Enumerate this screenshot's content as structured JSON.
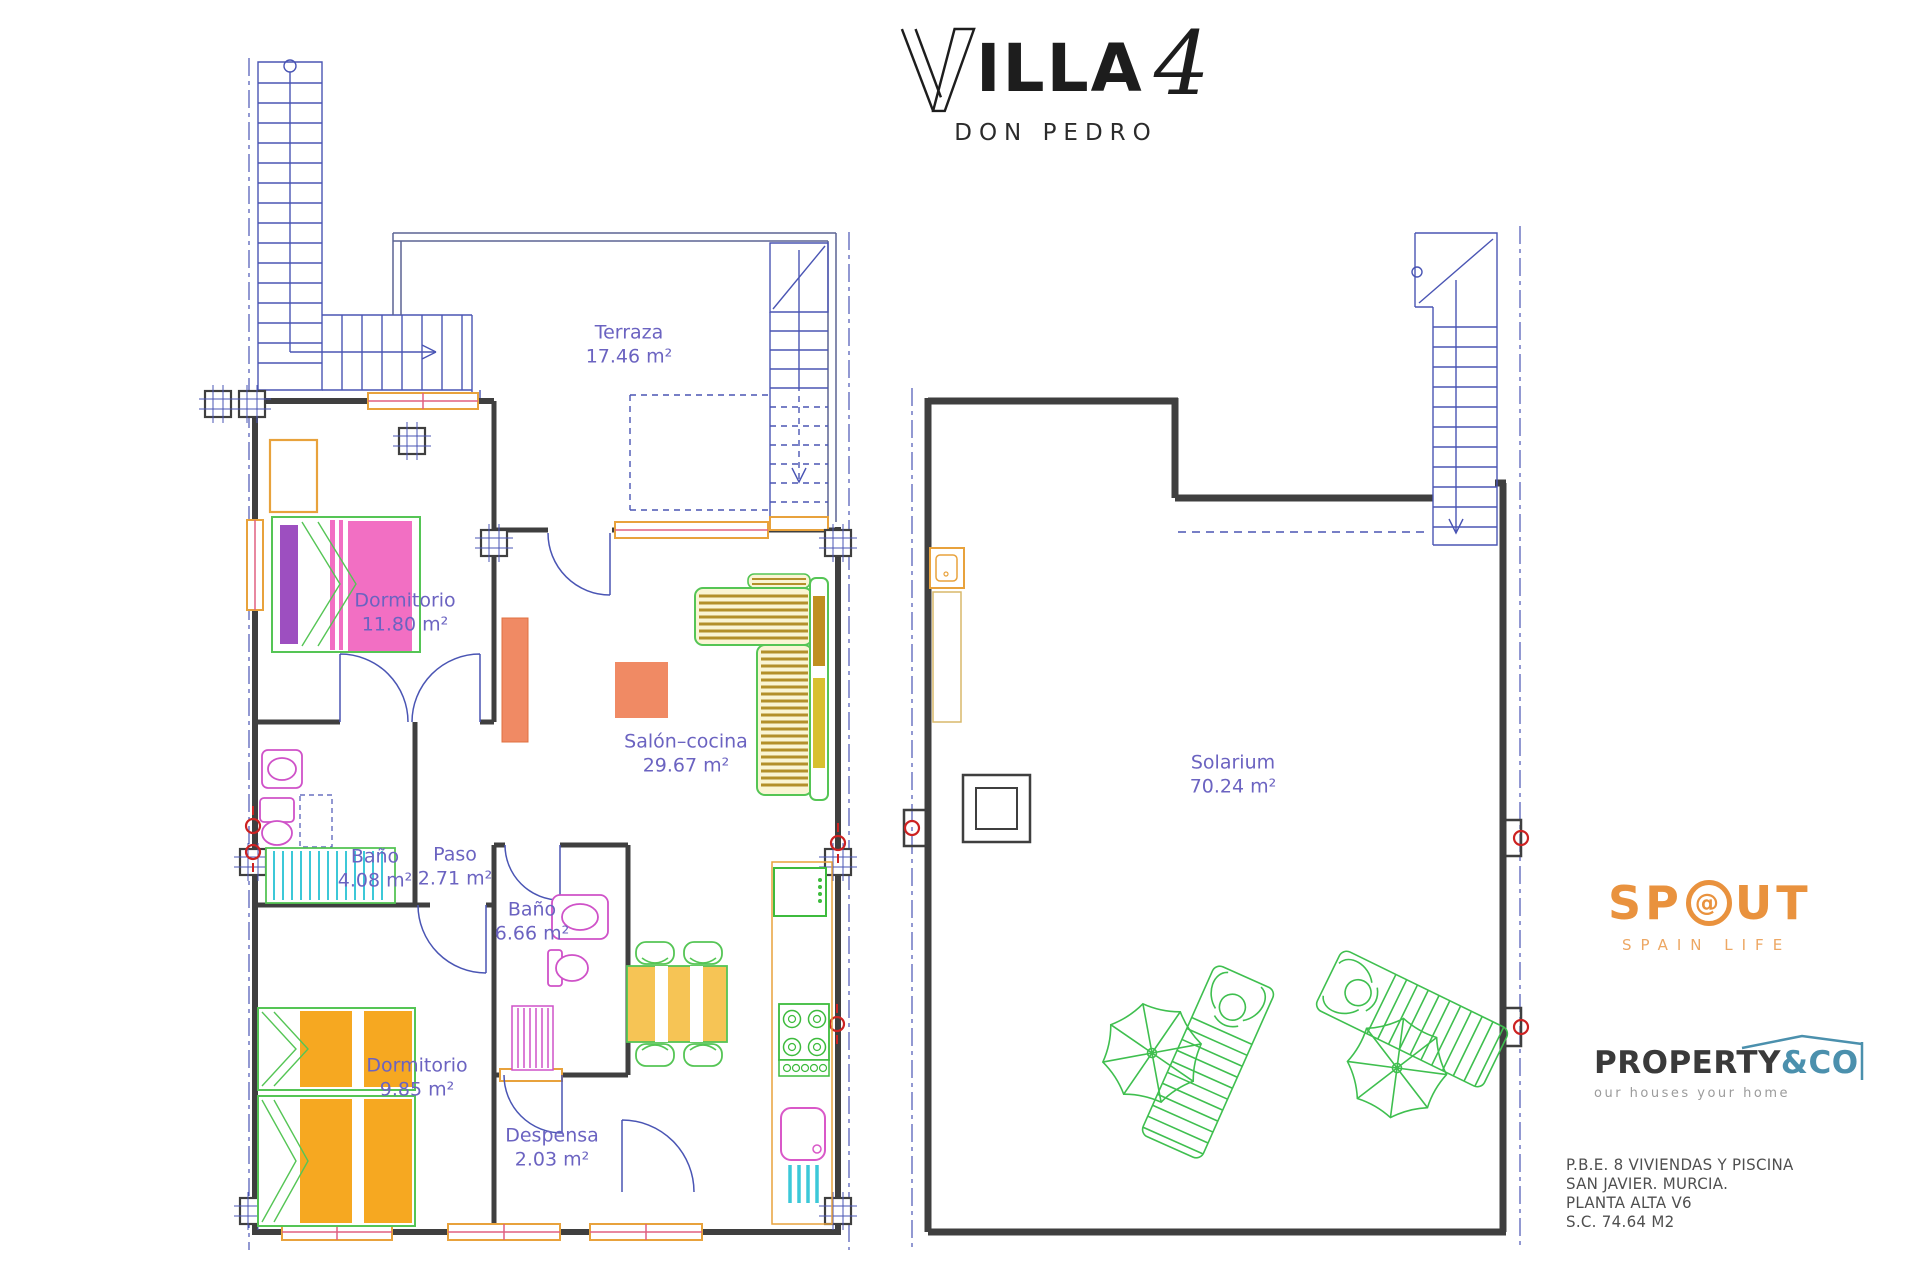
{
  "title": {
    "wordmark": "VILLA",
    "brand_rest": "ILLA",
    "number": "4",
    "subtitle": "DON PEDRO"
  },
  "floorplans": {
    "left": {
      "rooms": [
        {
          "name": "Terraza",
          "area": "17.46 m²"
        },
        {
          "name": "Dormitorio",
          "area": "11.80 m²"
        },
        {
          "name": "Baño",
          "area": "4.08 m²"
        },
        {
          "name": "Paso",
          "area": "2.71 m²"
        },
        {
          "name": "Salón–cocina",
          "area": "29.67 m²"
        },
        {
          "name": "Baño",
          "area": "6.66 m²"
        },
        {
          "name": "Dormitorio",
          "area": "9.85 m²"
        },
        {
          "name": "Despensa",
          "area": "2.03 m²"
        }
      ]
    },
    "right": {
      "rooms": [
        {
          "name": "Solarium",
          "area": "70.24 m²"
        }
      ]
    }
  },
  "branding": {
    "spout": {
      "part1": "SP",
      "o_glyph": "@",
      "part2": "UT",
      "subtitle": "SPAIN LIFE",
      "color": "#e9923e"
    },
    "property_co": {
      "part1": "PROPERTY",
      "part2": "&CO",
      "tagline": "our houses your home",
      "accent": "#4b90ad"
    }
  },
  "project_info": {
    "lines": [
      "P.B.E. 8 VIVIENDAS Y PISCINA",
      "SAN JAVIER. MURCIA.",
      "PLANTA ALTA V6",
      "S.C. 74.64 M2"
    ]
  },
  "colors": {
    "label_text": "#6b63c1",
    "walls": "#3f3f3f",
    "cad_blue": "#4a55b4",
    "window_orange": "#e8a23c",
    "furniture_green": "#55c555",
    "bed_pink": "#f26fc3",
    "pillow_purple": "#9d4fc0",
    "bed_orange": "#f6a821",
    "table_yellow": "#f6c455",
    "water_cyan": "#3cc8d8",
    "fixture_magenta": "#cf52c8",
    "marker_red": "#cc2222",
    "sofa_olive": "#b3902a",
    "salmon": "#f08a64"
  }
}
